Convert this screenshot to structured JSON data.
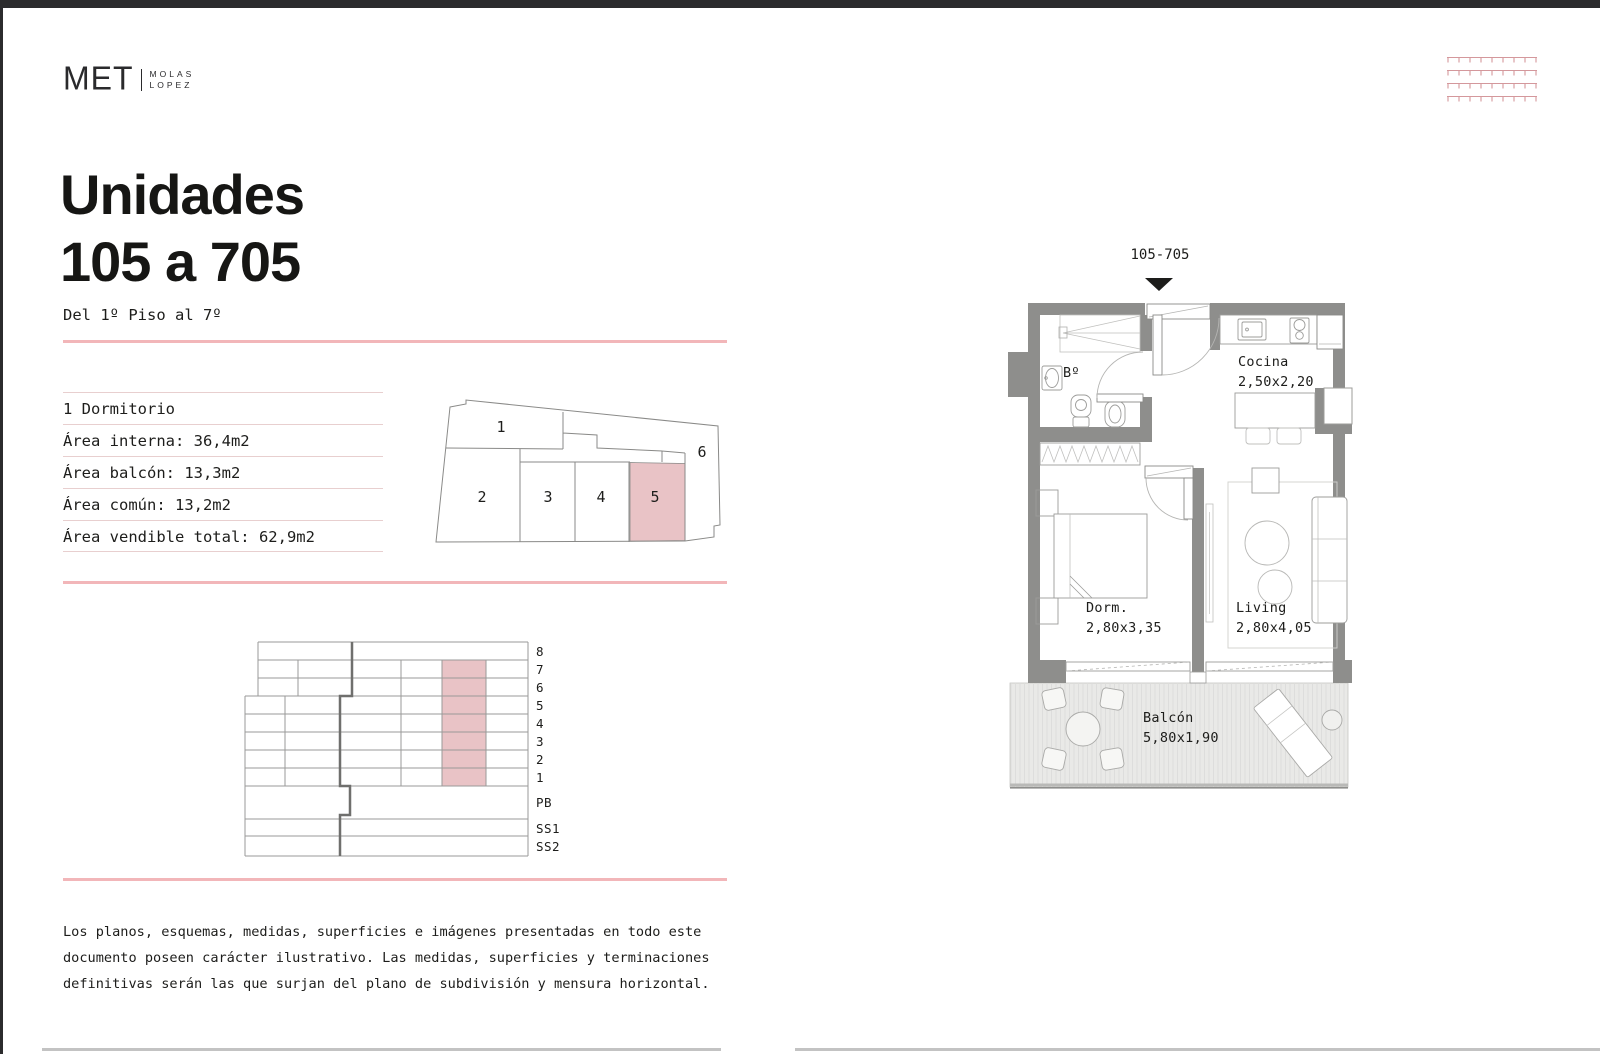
{
  "logo": {
    "met": "MET",
    "sub1": "MOLAS",
    "sub2": "LOPEZ"
  },
  "title": {
    "line1": "Unidades",
    "line2": "105 a 705"
  },
  "subtitle": "Del 1º Piso al 7º",
  "specs": [
    "1 Dormitorio",
    "Área interna: 36,4m2",
    "Área balcón: 13,3m2",
    "Área común: 13,2m2",
    "Área vendible total: 62,9m2"
  ],
  "floorplate": {
    "units": [
      "1",
      "2",
      "3",
      "4",
      "5",
      "6"
    ],
    "highlighted_unit": "5"
  },
  "section": {
    "floors": [
      "8",
      "7",
      "6",
      "5",
      "4",
      "3",
      "2",
      "1",
      "PB",
      "SS1",
      "SS2"
    ],
    "highlighted_floors": "7,6,5,4,3,2,1"
  },
  "plan": {
    "unit_label": "105-705",
    "rooms": [
      {
        "name": "Bº",
        "size": ""
      },
      {
        "name": "Cocina",
        "size": "2,50x2,20"
      },
      {
        "name": "Dorm.",
        "size": "2,80x3,35"
      },
      {
        "name": "Living",
        "size": "2,80x4,05"
      },
      {
        "name": "Balcón",
        "size": "5,80x1,90"
      }
    ]
  },
  "disclaimer": [
    "Los planos, esquemas, medidas, superficies e imágenes presentadas en todo este",
    "documento poseen carácter ilustrativo. Las medidas, superficies y terminaciones",
    "definitivas serán las que surjan del plano de subdivisión y mensura horizontal."
  ],
  "colors": {
    "accent_pink": "#f2b6b9",
    "highlight_fill": "#e9c3c6",
    "wall_gray": "#8e8e8c",
    "pattern_pink": "#d4989c",
    "page_border": "#2b2b2d"
  }
}
